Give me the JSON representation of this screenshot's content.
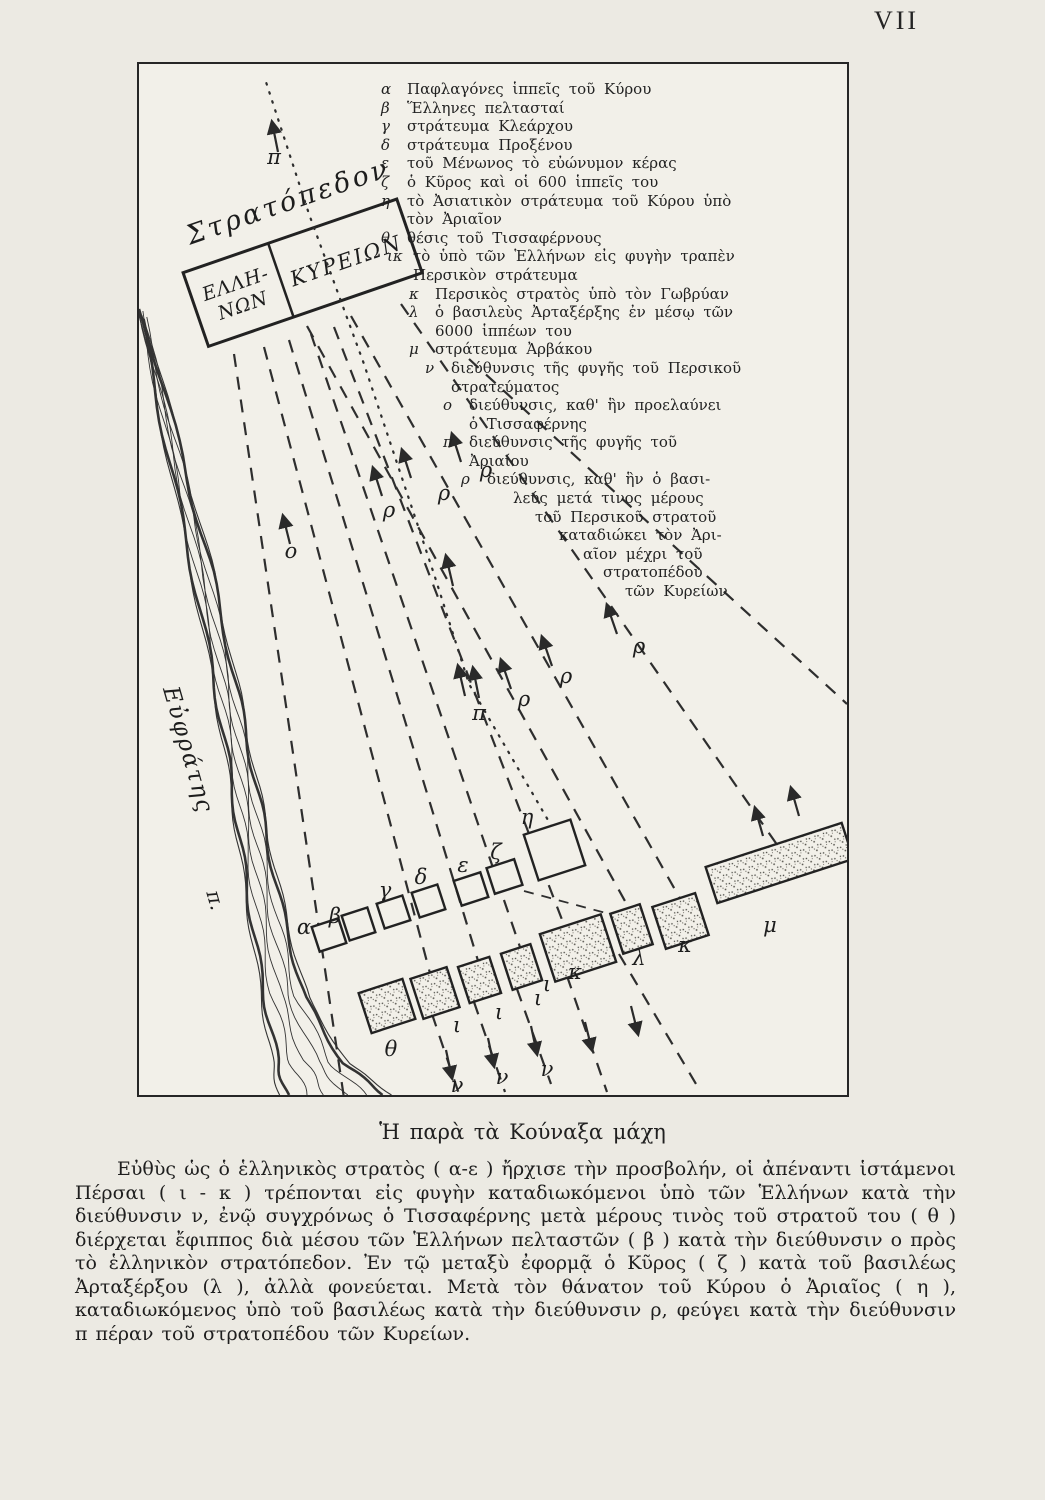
{
  "page": {
    "number": "VII"
  },
  "caption": "Ἡ παρὰ τὰ Κούναξα μάχη",
  "body": "Εὐθὺς ὡς ὁ ἑλληνικὸς στρατὸς ( α-ε ) ἤρχισε τὴν προσβολήν, οἱ ἀπέναντι ἱστάμενοι Πέρσαι ( ι - κ ) τρέπονται εἰς φυγὴν καταδιωκόμενοι ὑπὸ τῶν Ἑλλήνων κατὰ τὴν διεύθυνσιν ν, ἐνῷ συγχρόνως ὁ Τισσαφέρνης μετὰ μέρους τινὸς τοῦ στρατοῦ του ( θ ) διέρχεται ἔφιππος διὰ μέσου τῶν Ἑλλήνων πελταστῶν ( β ) κατὰ τὴν διεύθυνσιν ο πρὸς τὸ ἑλληνικὸν στρατόπεδον. Ἐν τῷ μεταξὺ ἐφορμᾷ ὁ Κῦρος ( ζ ) κατὰ τοῦ βασιλέως Ἀρταξέρξου (λ ), ἀλλὰ φονεύεται. Μετὰ τὸν θάνατον τοῦ Κύρου ὁ Ἀριαῖος ( η ), καταδιωκόμενος ὑπὸ τοῦ βασιλέως κατὰ τὴν διεύθυνσιν ρ, φεύγει κατὰ τὴν διεύθυνσιν π πέραν τοῦ στρατοπέδου τῶν Κυρείων.",
  "map": {
    "ink_color": "#2e2e2e",
    "paper_color": "#f2f0e9",
    "camp": {
      "title": "Στρατόπεδον",
      "left_lines": [
        "ΕΛΛΗ-",
        "ΝΩΝ"
      ],
      "right": "ΚΥΡΕΙΩΝ"
    },
    "river": {
      "name": "Εὐφράτης",
      "abbr": "π.",
      "left": [
        [
          0,
          245
        ],
        [
          25,
          370
        ],
        [
          50,
          490
        ],
        [
          72,
          600
        ],
        [
          88,
          690
        ],
        [
          100,
          770
        ],
        [
          112,
          850
        ],
        [
          125,
          930
        ],
        [
          138,
          995
        ],
        [
          148,
          1031
        ]
      ],
      "right": [
        [
          6,
          255
        ],
        [
          42,
          390
        ],
        [
          72,
          505
        ],
        [
          96,
          615
        ],
        [
          113,
          700
        ],
        [
          129,
          780
        ],
        [
          146,
          860
        ],
        [
          166,
          935
        ],
        [
          205,
          1000
        ],
        [
          246,
          1031
        ]
      ]
    },
    "legend": [
      {
        "key": "α",
        "text": "Παφλαγόνες ἱππεῖς τοῦ Κύρου",
        "level": 0
      },
      {
        "key": "β",
        "text": "Ἕλληνες πελτασταί",
        "level": 0
      },
      {
        "key": "γ",
        "text": "στράτευμα Κλεάρχου",
        "level": 0
      },
      {
        "key": "δ",
        "text": "στράτευμα Προξένου",
        "level": 0
      },
      {
        "key": "ε",
        "text": "τοῦ Μένωνος τὸ εὐώνυμον κέρας",
        "level": 0
      },
      {
        "key": "ζ",
        "text": "ὁ Κῦρος καὶ οἱ 600 ἱππεῖς του",
        "level": 0
      },
      {
        "key": "η",
        "lines": [
          "τὸ Ἀσιατικὸν στράτευμα τοῦ Κύρου ὑπὸ",
          "τὸν Ἀριαῖον"
        ],
        "level": 0
      },
      {
        "key": "θ",
        "text": "θέσις τοῦ Τισσαφέρνους",
        "level": 0
      },
      {
        "key": "ικ",
        "lines": [
          "τὸ ὑπὸ τῶν Ἑλλήνων εἰς φυγὴν τραπὲν",
          "Περσικὸν στράτευμα"
        ],
        "level": 1
      },
      {
        "key": "κ",
        "text": "Περσικὸς στρατὸς ὑπὸ τὸν Γωβρύαν",
        "level": 2
      },
      {
        "key": "λ",
        "lines": [
          "ὁ βασιλεὺς Ἀρταξέρξης ἐν μέσῳ τῶν",
          "6000 ἱππέων του"
        ],
        "level": 2
      },
      {
        "key": "μ",
        "text": "στράτευμα Ἀρβάκου",
        "level": 2
      },
      {
        "key": "ν",
        "lines": [
          "διεύθυνσις τῆς φυγῆς τοῦ Περσικοῦ",
          "στρατεύματος"
        ],
        "level": 3
      },
      {
        "key": "ο",
        "lines": [
          "διεύθυνσις, καθ' ἣν προελαύνει",
          "ὁ Τισσαφέρνης"
        ],
        "level": 4
      },
      {
        "key": "π",
        "lines": [
          "διεύθυνσις τῆς φυγῆς τοῦ",
          "Ἀριαίου"
        ],
        "level": 4
      },
      {
        "key": "ρ",
        "lines": [
          "διεύθυνσις, καθ' ἣν ὁ βασι-",
          "λεύς μετά τινος μέρους",
          "τοῦ Περσικοῦ στρατοῦ",
          "καταδιώκει τὸν Ἀρι-",
          "αῖον μέχρι τοῦ",
          "στρατοπέδου",
          "τῶν Κυρείων"
        ],
        "level": 5,
        "pyramid": true
      }
    ],
    "boxes": {
      "rotation": -18,
      "upper": [
        [
          176,
          858,
          28,
          26
        ],
        [
          206,
          847,
          27,
          26
        ],
        [
          241,
          835,
          27,
          26
        ],
        [
          276,
          824,
          27,
          26
        ],
        [
          318,
          812,
          28,
          26
        ],
        [
          351,
          799,
          29,
          27
        ],
        [
          391,
          762,
          49,
          48
        ]
      ],
      "lower": [
        [
          225,
          921,
          46,
          42
        ],
        [
          277,
          908,
          38,
          42
        ],
        [
          324,
          897,
          33,
          38
        ],
        [
          367,
          884,
          31,
          38
        ],
        [
          407,
          859,
          64,
          50
        ],
        [
          477,
          844,
          31,
          42
        ],
        [
          519,
          835,
          45,
          44
        ],
        [
          569,
          780,
          143,
          38
        ]
      ]
    },
    "letters": [
      {
        "t": "α",
        "x": 165,
        "y": 870
      },
      {
        "t": "β",
        "x": 196,
        "y": 859
      },
      {
        "t": "γ",
        "x": 246,
        "y": 833
      },
      {
        "t": "δ",
        "x": 282,
        "y": 820
      },
      {
        "t": "ε",
        "x": 324,
        "y": 808
      },
      {
        "t": "ζ",
        "x": 357,
        "y": 795
      },
      {
        "t": "η",
        "x": 388,
        "y": 760
      },
      {
        "t": "θ",
        "x": 252,
        "y": 992
      },
      {
        "t": "ι",
        "x": 318,
        "y": 968
      },
      {
        "t": "ι",
        "x": 360,
        "y": 955
      },
      {
        "t": "ι",
        "x": 399,
        "y": 941
      },
      {
        "t": "ι",
        "x": 408,
        "y": 927
      },
      {
        "t": "κ",
        "x": 436,
        "y": 915
      },
      {
        "t": "λ",
        "x": 500,
        "y": 901
      },
      {
        "t": "κ",
        "x": 546,
        "y": 888
      },
      {
        "t": "μ",
        "x": 631,
        "y": 868
      },
      {
        "t": "ν",
        "x": 318,
        "y": 1028
      },
      {
        "t": "ν",
        "x": 363,
        "y": 1020
      },
      {
        "t": "ν",
        "x": 408,
        "y": 1012
      },
      {
        "t": "ο",
        "x": 152,
        "y": 494
      },
      {
        "t": "ρ",
        "x": 250,
        "y": 453
      },
      {
        "t": "ρ",
        "x": 305,
        "y": 436
      },
      {
        "t": "ρ",
        "x": 347,
        "y": 413
      },
      {
        "t": "ρ",
        "x": 385,
        "y": 642
      },
      {
        "t": "ρ",
        "x": 427,
        "y": 619
      },
      {
        "t": "ρ",
        "x": 500,
        "y": 589
      },
      {
        "t": "π",
        "x": 135,
        "y": 100
      },
      {
        "t": "π",
        "x": 340,
        "y": 656
      }
    ],
    "dashed_lines": [
      [
        95,
        290,
        205,
        1034
      ],
      [
        125,
        283,
        292,
        913
      ],
      [
        150,
        276,
        340,
        900
      ],
      [
        172,
        270,
        382,
        886
      ],
      [
        195,
        263,
        427,
        866
      ],
      [
        168,
        262,
        492,
        848
      ],
      [
        212,
        252,
        543,
        838
      ],
      [
        262,
        240,
        648,
        795
      ],
      [
        330,
        295,
        708,
        640
      ],
      [
        293,
        950,
        320,
        1030
      ],
      [
        335,
        938,
        366,
        1028
      ],
      [
        378,
        925,
        412,
        1020
      ],
      [
        428,
        912,
        468,
        1028
      ],
      [
        480,
        890,
        560,
        1025
      ]
    ],
    "attack_line": [
      385,
      827,
      478,
      852
    ],
    "dotted_path": [
      [
        413,
        763
      ],
      [
        330,
        620
      ],
      [
        295,
        510
      ],
      [
        225,
        300
      ],
      [
        170,
        150
      ],
      [
        127,
        18
      ]
    ],
    "arrows": [
      [
        151,
        480,
        144,
        452
      ],
      [
        243,
        432,
        234,
        404
      ],
      [
        272,
        414,
        263,
        386
      ],
      [
        322,
        398,
        313,
        370
      ],
      [
        372,
        625,
        362,
        596
      ],
      [
        413,
        602,
        403,
        573
      ],
      [
        478,
        570,
        468,
        541
      ],
      [
        340,
        634,
        334,
        604
      ],
      [
        139,
        88,
        133,
        58
      ],
      [
        326,
        632,
        319,
        602
      ],
      [
        314,
        522,
        307,
        492
      ],
      [
        307,
        986,
        313,
        1014
      ],
      [
        349,
        974,
        355,
        1002
      ],
      [
        392,
        962,
        398,
        990
      ],
      [
        446,
        958,
        453,
        986
      ],
      [
        492,
        942,
        499,
        970
      ],
      [
        624,
        772,
        616,
        744
      ],
      [
        660,
        752,
        652,
        724
      ]
    ]
  }
}
